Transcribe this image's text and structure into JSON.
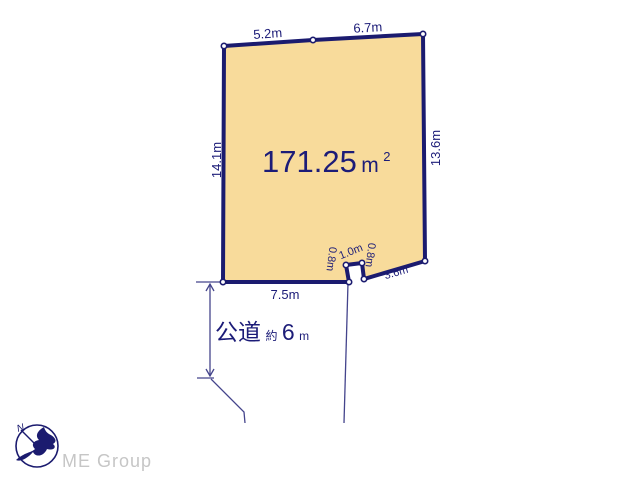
{
  "plot": {
    "area_value": "171.25",
    "area_unit_base": "m",
    "area_unit_sup": "2",
    "edges": {
      "top_left_segment": "5.2m",
      "top_right_segment": "6.7m",
      "left": "14.1m",
      "right": "13.6m",
      "bottom": "7.5m",
      "notch_left": "0.8m",
      "notch_top": "1.0m",
      "notch_right": "0.8m",
      "bottom_right_diagonal": "3.6m"
    }
  },
  "road": {
    "type": "公道",
    "approx_prefix": "約",
    "width_value": "6",
    "width_unit": "m"
  },
  "footer": {
    "brand": "ME Group",
    "compass_north": "N"
  },
  "colors": {
    "plot_fill": "#F8DB9B",
    "boundary_navy": "#1B1B6F",
    "label_navy": "#1C1C78",
    "thin_line": "#44448C",
    "brand_gray": "#C6C6C6",
    "background": "#FFFFFF"
  }
}
